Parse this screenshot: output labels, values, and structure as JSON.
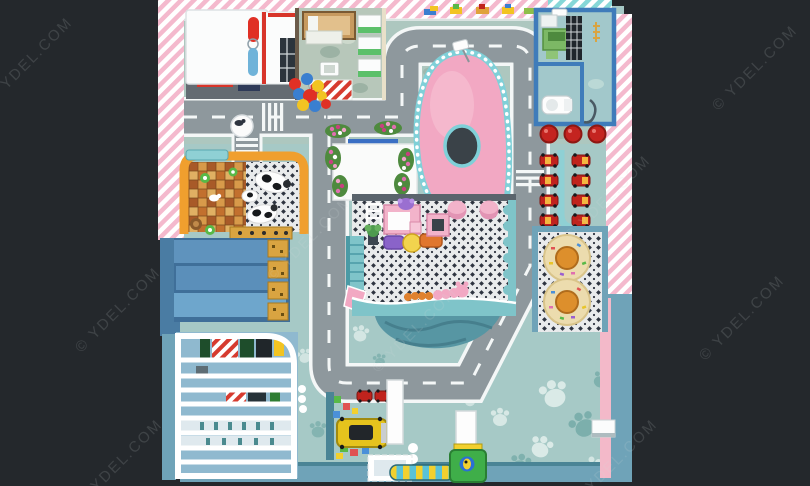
{
  "watermark": {
    "text": "© YDEL.COM"
  },
  "colors": {
    "background": "#24282c",
    "stripePink": "#f4b9cd",
    "stripeTeal": "#86d7d7",
    "floorTeal": "#a6c9c6",
    "floorSage": "#b3c4ba",
    "pawWhite": "#e8f3f0",
    "pawTeal": "#6fa7a4",
    "roadAsphalt": "#8e989d",
    "roadLine": "#f4f7f7",
    "moundPink": "#f2a8c3",
    "moundLight": "#f7c3d3",
    "holeDark": "#3a4248",
    "rimTeal": "#7fd0d8",
    "mosaicLight": "#e9ebec",
    "mosaicDark": "#2e3440",
    "pondTeal": "#5796a3",
    "ledgeTeal": "#7fc4c9",
    "frameOrange": "#f09f2e",
    "goldAccent": "#d9a441",
    "roofBlue": "#5f93bd",
    "roofBlueDark": "#3f6f99",
    "shelfBlue": "#8fb9cf",
    "busYellow": "#e6c31d",
    "slideGreen": "#3fae49",
    "catYellow": "#f2d02e",
    "catBlue": "#59c2d8",
    "stoolRed": "#c42420",
    "carRed": "#c0231d",
    "carYellow": "#f4b63f",
    "tableTan": "#ecdcae",
    "capOrange": "#dd8f2c",
    "vanityPink": "#f2b3ca",
    "ottomanPurple": "#8a63c9",
    "ottomanOrange": "#e0762e",
    "stoolYellow": "#f2d44e",
    "balloonRed": "#e03025",
    "balloonBlue": "#3a7fd0",
    "balloonYellow": "#f2c422",
    "wallBlue": "#6fa3b8",
    "wallBlueDeep": "#4a7ca3",
    "pinkBand": "#f3b9c9",
    "greenShelf": "#5cc06a",
    "deskGreen": "#7cb865",
    "woodTan": "#c79a5f",
    "checkerA": "#d89a4a",
    "checkerB": "#a85a28",
    "checkerC": "#e0b063",
    "checkerD": "#c2702e",
    "darkWall": "#5a646c",
    "white": "#fbfcfc"
  }
}
